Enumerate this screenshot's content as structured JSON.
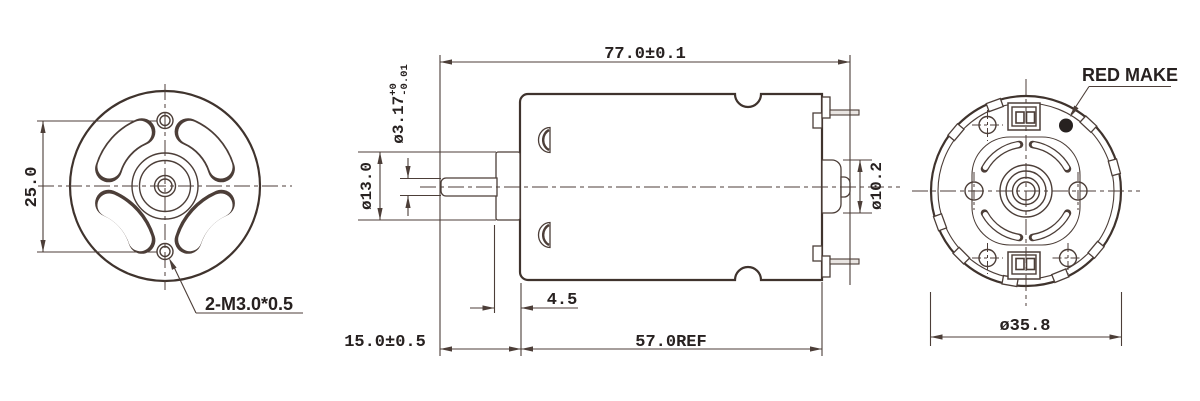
{
  "drawing": {
    "front_view": {
      "dim_mount_spacing": "25.0",
      "thread_callout": "2-M3.0*0.5"
    },
    "side_view": {
      "dim_overall_length": "77.0±0.1",
      "dim_shaft_length": "15.0±0.5",
      "dim_body_length": "57.0REF",
      "dim_collar_width": "4.5",
      "dim_shaft_diameter": "ø3.17",
      "dim_shaft_tol_plus": "+0",
      "dim_shaft_tol_minus": "-0.01",
      "dim_collar_diameter": "ø13.0",
      "dim_boss_diameter": "ø10.2"
    },
    "back_view": {
      "dim_outer_diameter": "ø35.8",
      "red_mark_label": "RED MAKE"
    },
    "colors": {
      "line": "#4c3e38",
      "outline": "#3f332d",
      "text": "#272120",
      "background": "#ffffff"
    }
  }
}
